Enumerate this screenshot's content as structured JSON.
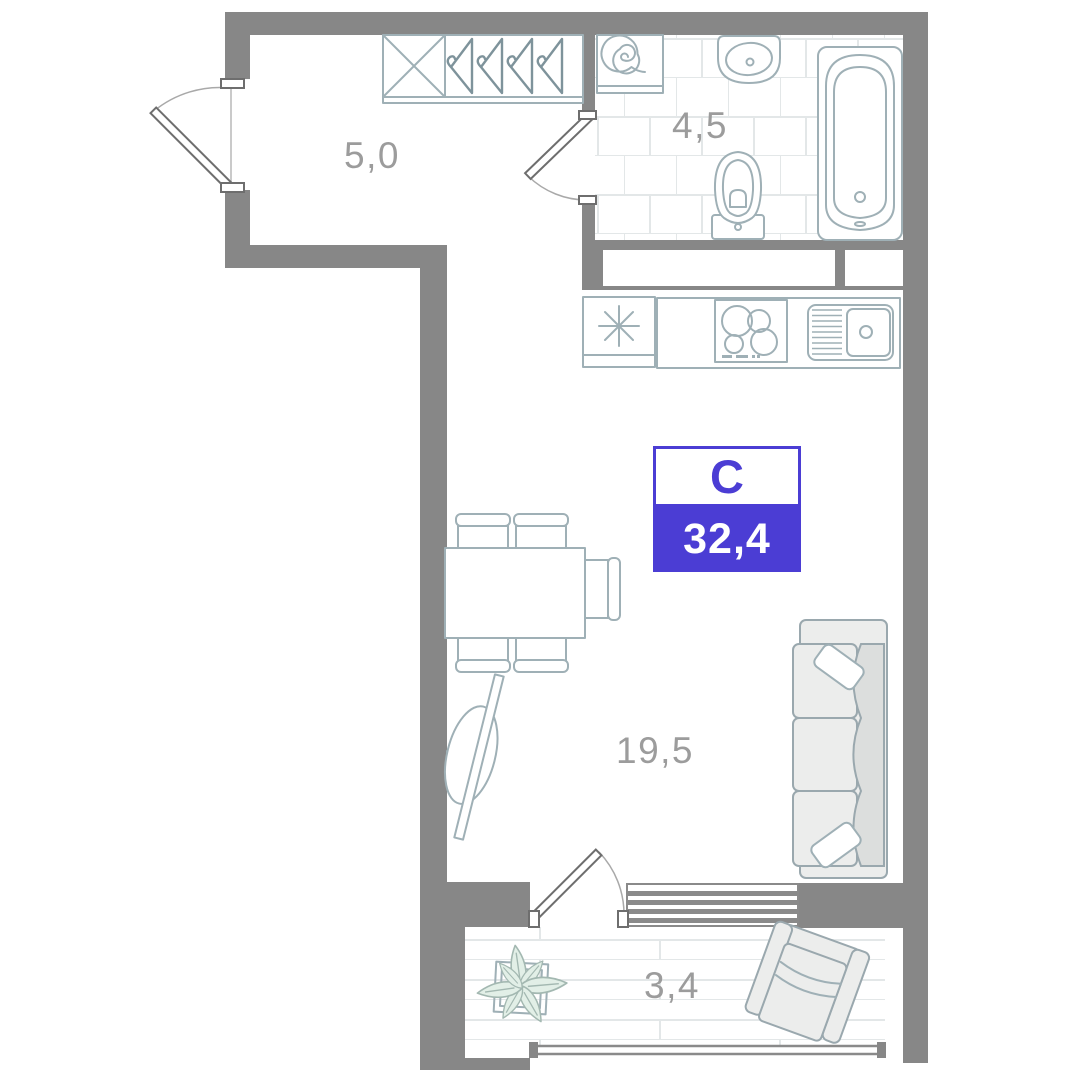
{
  "floor_plan": {
    "badge": {
      "building_label": "С",
      "total_area": "32,4",
      "accent_color": "#4b3dd4"
    },
    "rooms": {
      "hallway": {
        "area": "5,0",
        "features": [
          "entrance-door",
          "wardrobe-unit",
          "clothes-hangers"
        ]
      },
      "bathroom": {
        "area": "4,5",
        "features": [
          "washing-machine",
          "washbasin",
          "toilet",
          "bathtub",
          "tiled-floor"
        ]
      },
      "living": {
        "area": "19,5",
        "features": [
          "fridge",
          "kitchen-counter",
          "hob",
          "kitchen-sink",
          "dining-table",
          "chairs",
          "tv",
          "sofa"
        ]
      },
      "balcony": {
        "area": "3,4",
        "features": [
          "plant",
          "armchair",
          "radiator-grille",
          "plank-floor",
          "window-band"
        ]
      }
    },
    "colors": {
      "wall": "#878787",
      "furniture_line": "#9fb0b6",
      "label_text": "#9c9c9c",
      "accent": "#4b3dd4",
      "upholstery_fill": "#ecedec",
      "leaf_fill": "#e2efe7",
      "tile_line": "#e3e7e8"
    }
  }
}
